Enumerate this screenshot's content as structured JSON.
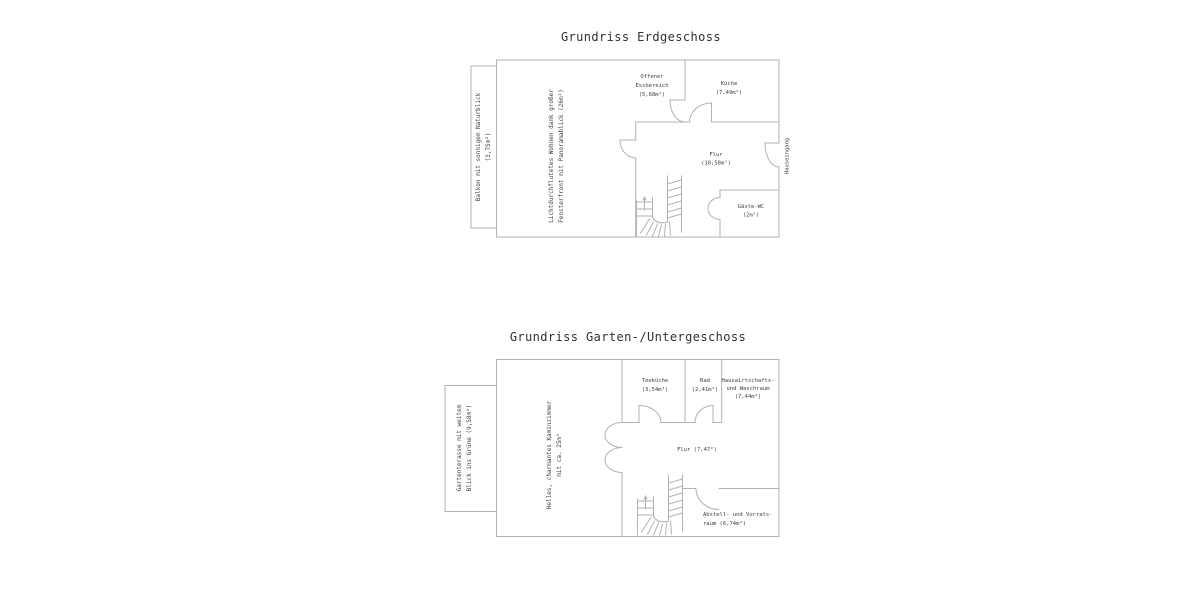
{
  "colors": {
    "background": "#ffffff",
    "wall": "#b2b2b2",
    "text": "#404040",
    "title": "#303030"
  },
  "floorplans": [
    {
      "title": "Grundriss Erdgeschoss",
      "balcony": {
        "line1": "Balkon mit sonnigem Naturblick",
        "line2": "(3,75m²)"
      },
      "living": {
        "line1": "Lichtdurchflutetes Wohnen dank großer",
        "line2": "Fensterfront mit Panoramablick (26m²)"
      },
      "dining": {
        "line1": "Offener",
        "line2": "Essbereich",
        "line3": "(5,68m²)"
      },
      "kitchen": {
        "line1": "Küche",
        "line2": "(7,49m²)"
      },
      "hall": {
        "line1": "Flur",
        "line2": "(10,58m²)"
      },
      "wc": {
        "line1": "Gäste-WC",
        "line2": "(2m²)"
      },
      "entrance": {
        "label": "Hauseingang"
      }
    },
    {
      "title": "Grundriss Garten-/Untergeschoss",
      "terrace": {
        "line1": "Gartenterasse mit weitem",
        "line2": "Blick ins Grüne (9,58m²)"
      },
      "fireroom": {
        "line1": "Helles, charmantes Kaminzimmer",
        "line2": "mit ca. 25m²"
      },
      "teakitchen": {
        "line1": "Teeküche",
        "line2": "(3,54m²)"
      },
      "bath": {
        "line1": "Bad",
        "line2": "(2,41m²)"
      },
      "utility": {
        "line1": "Hauswirtschafts-",
        "line2": "und Waschraum",
        "line3": "(7,44m²)"
      },
      "hall": {
        "label": "Flur (7,47²)"
      },
      "storage": {
        "line1": "Abstell- und Vorrats-",
        "line2": "raum (6,74m²)"
      }
    }
  ]
}
